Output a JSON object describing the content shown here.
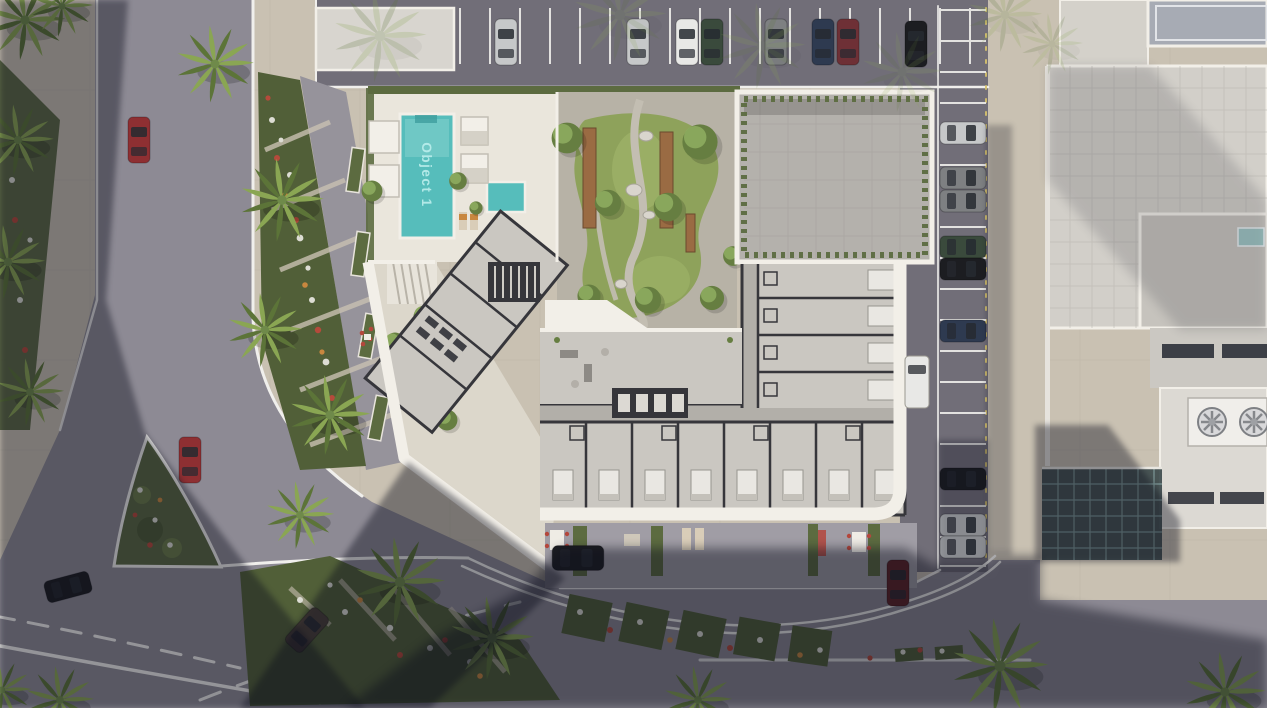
{
  "scene": {
    "type": "aerial-architectural-render",
    "labels": {
      "pool_label": "Object 1"
    },
    "colors": {
      "paving": "#c9c1b2",
      "paving_dark": "#a79f92",
      "road": "#8d8a94",
      "asphalt": "#716e78",
      "deck": "#eae6dc",
      "deck_low": "#dcd7cb",
      "floor": "#cac7c1",
      "corridor": "#b2afa9",
      "wall_dark": "#36363b",
      "wall_white": "#f2efe8",
      "roof_gray": "#b4b1ac",
      "lawn": "#8ea25b",
      "lawn_light": "#a8bd70",
      "hedge": "#5c6b40",
      "tree_dark": "#667e41",
      "tree_light": "#8fae62",
      "palm_light": "#8aa653",
      "palm_dark": "#5c7438",
      "bed_green": "#515f38",
      "flower_white": "#ddddd4",
      "flower_red": "#b54a3b",
      "flower_orange": "#c8873f",
      "pool": "#56bdbb",
      "pool_light": "#9fdeda",
      "pool_text": "#b7ecea",
      "wood": "#9a6b43",
      "right_roof": "#d2cfc9",
      "right_panel_blue": "#a7abb4",
      "glass_teal": "#9fc4c2",
      "canopy_dark": "#3d4b4c",
      "marking": "#f0efec",
      "marking_yellow": "#d8c36a",
      "shadow": "#0c0e1c",
      "veh_silver": "#c6c8c9",
      "veh_white": "#e8e8e6",
      "veh_black": "#1c1d21",
      "veh_gray": "#7e8082",
      "veh_navy": "#2e3a50",
      "veh_maroon": "#6e3036",
      "veh_green": "#3a4a3c",
      "veh_red": "#8e2f32",
      "veh_darkred": "#5e2326",
      "veh_brown": "#4a4038",
      "furniture_red": "#b4473c"
    },
    "vehicles": {
      "top_parking_row": [
        "silver",
        "silver",
        "white",
        "dark-green",
        "gray",
        "navy",
        "maroon",
        "black-suv"
      ],
      "side_parking_column": [
        "silver",
        "dark-gray",
        "dark-gray",
        "dark-green",
        "black",
        "navy",
        "black",
        "silver",
        "silver"
      ],
      "road_cars": [
        "red-sedan-north-road",
        "red-sedan-junction",
        "black-sedan-junction",
        "brown-sedan-south-road",
        "dark-sedan-parked-south",
        "dark-red-sedan-inner-road",
        "white-van-inner-road"
      ]
    },
    "site": {
      "pool_area": "rooftop pool deck with cabanas and kids pool",
      "courtyard": "landscaped courtyard with lawn, winding paths, wooden benches and trees",
      "building": "residential building shown as cutaway floor plan with furnished units",
      "roof_block": "gray roof block with perimeter hedge",
      "parking": "surface parking lot (top) and parking strip (right)",
      "adjacent_building": "neighboring building with rooftop HVAC fans and glass canopy",
      "streetscape": "roads with white lane markings, triangular planted island, flower beds and palm trees"
    }
  }
}
